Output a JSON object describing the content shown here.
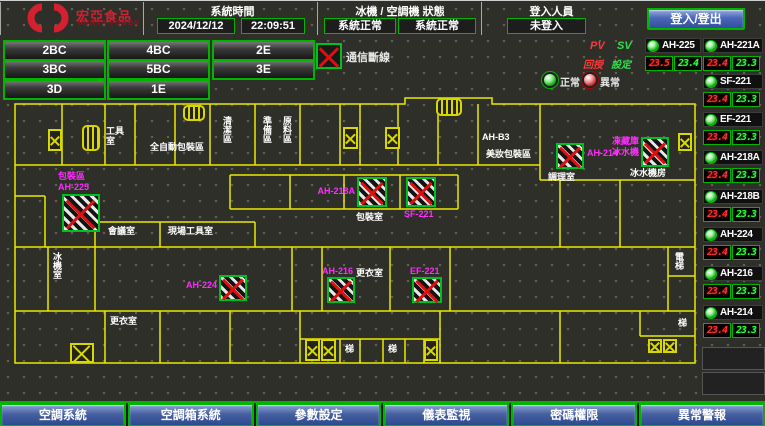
{
  "header": {
    "logo_line1": "宏亞食品",
    "logo_line2": "HUNYA FOODS",
    "time_label": "系統時間",
    "date": "2024/12/12",
    "time": "22:09:51",
    "status_label": "冰機 / 空調機 狀態",
    "chiller_status": "系統正常",
    "ahu_status": "系統正常",
    "login_label": "登入人員",
    "login_status": "未登入",
    "login_button": "登入/登出"
  },
  "floors": {
    "items": [
      {
        "label": "2BC",
        "x": 3,
        "y": 39
      },
      {
        "label": "4BC",
        "x": 107,
        "y": 39
      },
      {
        "label": "2E",
        "x": 212,
        "y": 39
      },
      {
        "label": "3BC",
        "x": 3,
        "y": 58
      },
      {
        "label": "5BC",
        "x": 107,
        "y": 58
      },
      {
        "label": "3E",
        "x": 212,
        "y": 58
      },
      {
        "label": "3D",
        "x": 3,
        "y": 78
      },
      {
        "label": "1E",
        "x": 107,
        "y": 78
      }
    ]
  },
  "legend": {
    "offline_label": "通信斷線",
    "pv": "PV",
    "sv": "SV",
    "feedback": "回授",
    "setpoint": "設定",
    "normal": "正常",
    "abnormal": "異常"
  },
  "units": [
    {
      "name": "AH-225",
      "pv": "23.5",
      "sv": "23.4",
      "x": 645,
      "y": 37,
      "w": 56
    },
    {
      "name": "AH-221A",
      "pv": "23.4",
      "sv": "23.3",
      "x": 703,
      "y": 37,
      "w": 60
    },
    {
      "name": "SF-221",
      "pv": "23.4",
      "sv": "23.3",
      "x": 703,
      "y": 73,
      "w": 60
    },
    {
      "name": "EF-221",
      "pv": "23.4",
      "sv": "23.3",
      "x": 703,
      "y": 111,
      "w": 60
    },
    {
      "name": "AH-218A",
      "pv": "23.4",
      "sv": "23.3",
      "x": 703,
      "y": 149,
      "w": 60
    },
    {
      "name": "AH-218B",
      "pv": "23.4",
      "sv": "23.3",
      "x": 703,
      "y": 188,
      "w": 60
    },
    {
      "name": "AH-224",
      "pv": "23.4",
      "sv": "23.3",
      "x": 703,
      "y": 226,
      "w": 60
    },
    {
      "name": "AH-216",
      "pv": "23.4",
      "sv": "23.3",
      "x": 703,
      "y": 265,
      "w": 60
    },
    {
      "name": "AH-214",
      "pv": "23.4",
      "sv": "23.3",
      "x": 703,
      "y": 304,
      "w": 60
    }
  ],
  "map": {
    "rooms": [
      {
        "text": "工具室",
        "x": 106,
        "y": 30,
        "w": 22,
        "wrap": true
      },
      {
        "text": "全自動包裝區",
        "x": 150,
        "y": 46
      },
      {
        "text": "清潔區",
        "x": 222,
        "y": 20,
        "vert": true
      },
      {
        "text": "準備區",
        "x": 262,
        "y": 20,
        "vert": true
      },
      {
        "text": "原料區",
        "x": 282,
        "y": 20,
        "vert": true
      },
      {
        "text": "AH-B3",
        "x": 482,
        "y": 36
      },
      {
        "text": "美妝包裝區",
        "x": 486,
        "y": 53
      },
      {
        "text": "調理室",
        "x": 548,
        "y": 76
      },
      {
        "text": "冰水機房",
        "x": 630,
        "y": 72
      },
      {
        "text": "會議室",
        "x": 108,
        "y": 130
      },
      {
        "text": "現場工具室",
        "x": 168,
        "y": 130
      },
      {
        "text": "冰機室",
        "x": 52,
        "y": 156,
        "vert": true
      },
      {
        "text": "包裝室",
        "x": 356,
        "y": 116
      },
      {
        "text": "更衣室",
        "x": 356,
        "y": 172
      },
      {
        "text": "更衣室",
        "x": 110,
        "y": 220
      },
      {
        "text": "梯",
        "x": 345,
        "y": 248
      },
      {
        "text": "梯",
        "x": 388,
        "y": 248
      },
      {
        "text": "電梯",
        "x": 674,
        "y": 156,
        "vert": true
      },
      {
        "text": "梯",
        "x": 678,
        "y": 222
      }
    ],
    "devices": [
      {
        "x": 62,
        "y": 98,
        "w": 38,
        "h": 38,
        "labels": [
          {
            "text": "包裝區",
            "x": 58,
            "y": 75
          },
          {
            "text": "AH-225",
            "x": 58,
            "y": 86
          }
        ]
      },
      {
        "x": 357,
        "y": 81,
        "w": 30,
        "h": 30,
        "labels": [
          {
            "text": "AH-218A",
            "x": 315,
            "y": 90,
            "w": 40,
            "align": "r"
          }
        ]
      },
      {
        "x": 406,
        "y": 81,
        "w": 30,
        "h": 30,
        "labels": [
          {
            "text": "SF-221",
            "x": 404,
            "y": 113
          }
        ]
      },
      {
        "x": 219,
        "y": 179,
        "w": 28,
        "h": 26,
        "labels": [
          {
            "text": "AH-224",
            "x": 182,
            "y": 184,
            "w": 35,
            "align": "r"
          }
        ]
      },
      {
        "x": 327,
        "y": 181,
        "w": 28,
        "h": 26,
        "labels": [
          {
            "text": "AH-216",
            "x": 322,
            "y": 170
          }
        ]
      },
      {
        "x": 412,
        "y": 181,
        "w": 30,
        "h": 26,
        "labels": [
          {
            "text": "EF-221",
            "x": 410,
            "y": 170
          }
        ]
      },
      {
        "x": 556,
        "y": 47,
        "w": 28,
        "h": 26,
        "labels": [
          {
            "text": "AH-214",
            "x": 587,
            "y": 52
          }
        ]
      },
      {
        "x": 641,
        "y": 41,
        "w": 28,
        "h": 30,
        "labels": [
          {
            "text": "凍藏庫",
            "x": 608,
            "y": 40,
            "w": 31,
            "align": "r"
          },
          {
            "text": "冰水機",
            "x": 608,
            "y": 51,
            "w": 31,
            "align": "r"
          }
        ]
      }
    ],
    "shafts": [
      {
        "x": 48,
        "y": 33,
        "w": 14,
        "h": 22
      },
      {
        "x": 343,
        "y": 31,
        "w": 15,
        "h": 22
      },
      {
        "x": 385,
        "y": 31,
        "w": 15,
        "h": 22
      },
      {
        "x": 678,
        "y": 37,
        "w": 14,
        "h": 18
      },
      {
        "x": 70,
        "y": 247,
        "w": 24,
        "h": 20
      },
      {
        "x": 305,
        "y": 243,
        "w": 15,
        "h": 22
      },
      {
        "x": 321,
        "y": 243,
        "w": 15,
        "h": 22
      },
      {
        "x": 424,
        "y": 243,
        "w": 14,
        "h": 22
      },
      {
        "x": 648,
        "y": 243,
        "w": 14,
        "h": 14
      },
      {
        "x": 663,
        "y": 243,
        "w": 14,
        "h": 14
      }
    ],
    "stairs": [
      {
        "x": 82,
        "y": 29,
        "w": 18,
        "h": 26
      },
      {
        "x": 183,
        "y": 9,
        "w": 22,
        "h": 16
      },
      {
        "x": 436,
        "y": 2,
        "w": 26,
        "h": 18
      }
    ]
  },
  "bottom_nav": [
    "空調系統",
    "空調箱系統",
    "參數設定",
    "儀表監視",
    "密碼權限",
    "異常警報"
  ]
}
